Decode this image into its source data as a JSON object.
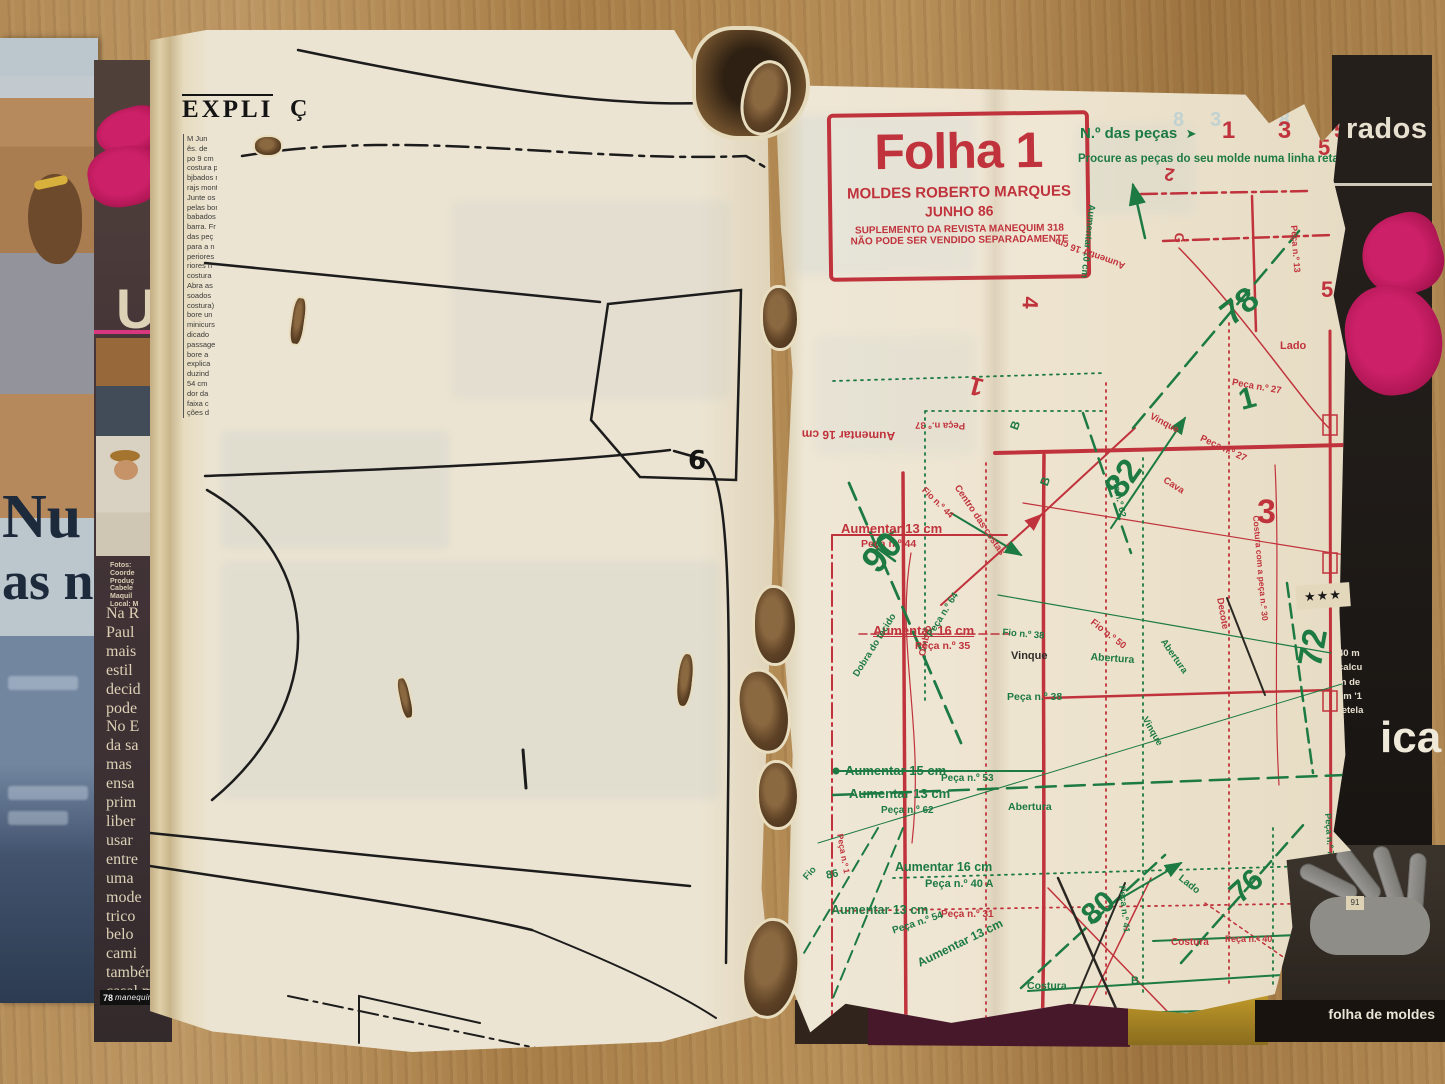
{
  "left_cover": {
    "headline_line1": "Nu",
    "headline_line2": "as n"
  },
  "middle_strip": {
    "big_letters": [
      "U",
      "d",
      "q"
    ],
    "credits": [
      "Fotos:",
      "Coorde",
      "Produç",
      "Cabele",
      "Maquil",
      "Local: M"
    ],
    "article_words": [
      "Na R",
      "Paul",
      "mais",
      "estil",
      "decid",
      "pode",
      "No E",
      "da sa",
      "mas",
      "ensa",
      "prim",
      "liber",
      "usar",
      "entre",
      "uma",
      "mode",
      "trico",
      "belo",
      "cami",
      "tambén",
      "casal m"
    ],
    "footer_number": "78",
    "footer_logo": "manequim"
  },
  "left_page": {
    "header_fragment": "EXPLI",
    "header_fragment2": "Ç",
    "column_lines": [
      "M Jun",
      "ês. de",
      "po 9 cm",
      "costura p",
      "bjbados r",
      "rajs mont",
      "Junte os",
      "pelas bor",
      "babados",
      "barra. Fr",
      "das peç",
      "para a n",
      "periores",
      "riores n",
      "costura",
      "Abra as",
      "soados",
      "costura)",
      "bore un",
      "minicurs",
      "dicado",
      "passage",
      "bore a",
      "explica",
      "duzind",
      "54 cm",
      "dor da",
      "faixa c",
      "ções d"
    ],
    "pattern_number": "6"
  },
  "right_page": {
    "info_box": {
      "title": "Folha 1",
      "publisher": "MOLDES ROBERTO MARQUES",
      "date": "JUNHO 86",
      "line3": "SUPLEMENTO DA REVISTA MANEQUIM 318",
      "line4": "NÃO PODE SER VENDIDO SEPARADAMENTE"
    },
    "pieces_header": {
      "label": "N.º das peças",
      "arrow_glyph": "➤",
      "numbers": [
        "1",
        "3",
        "5"
      ],
      "instruction": "Procure as peças do seu molde numa linha reta, v"
    },
    "ghost_numbers": "83 85",
    "labels": [
      {
        "t": "Aumentar 13  cm",
        "c": "red",
        "x": 66,
        "y": 436,
        "s": 13,
        "u": 1
      },
      {
        "t": "Peça n.º 44",
        "c": "red",
        "x": 86,
        "y": 453,
        "s": 10.5
      },
      {
        "t": "90",
        "c": "green",
        "x": 78,
        "y": 468,
        "r": -48,
        "s": 36
      },
      {
        "t": "Aumentar 16  cm",
        "c": "red",
        "x": 98,
        "y": 538,
        "s": 13,
        "u": 1
      },
      {
        "t": "Peça n.º 35",
        "c": "red",
        "x": 140,
        "y": 555,
        "s": 10.5
      },
      {
        "t": "Centro das costas",
        "c": "red",
        "x": 186,
        "y": 398,
        "r": 56,
        "s": 9.5
      },
      {
        "t": "Vinque",
        "c": "dark",
        "x": 236,
        "y": 565,
        "s": 11
      },
      {
        "t": "Fio n.º 38",
        "c": "green",
        "x": 228,
        "y": 542,
        "r": 5,
        "s": 9.5
      },
      {
        "t": "Abertura",
        "c": "green",
        "x": 316,
        "y": 566,
        "r": 4,
        "s": 10.5
      },
      {
        "t": "Fio n.º 50",
        "c": "red",
        "x": 320,
        "y": 532,
        "r": 38,
        "s": 9.5
      },
      {
        "t": "Peça n.º 38",
        "c": "green",
        "x": 232,
        "y": 606,
        "s": 10.5
      },
      {
        "t": "Ombro",
        "c": "red",
        "x": 142,
        "y": 570,
        "r": -78,
        "s": 9.5
      },
      {
        "t": "Dobra do tecido",
        "c": "green",
        "x": 76,
        "y": 588,
        "r": -58,
        "s": 9.5
      },
      {
        "t": "Peça n.º 64",
        "c": "green",
        "x": 150,
        "y": 548,
        "r": -58,
        "s": 9.5
      },
      {
        "t": "Aumentar 15  cm",
        "c": "green",
        "x": 70,
        "y": 678,
        "s": 13
      },
      {
        "t": "Peça n.º 53",
        "c": "green",
        "x": 166,
        "y": 688,
        "s": 10
      },
      {
        "t": "Aumentar 13  cm",
        "c": "green",
        "x": 74,
        "y": 701,
        "s": 13
      },
      {
        "t": "Peça n.º 62",
        "c": "green",
        "x": 106,
        "y": 720,
        "s": 10
      },
      {
        "t": "Abertura",
        "c": "green",
        "x": 233,
        "y": 716,
        "s": 10.5
      },
      {
        "t": "Aumentar 16  cm",
        "c": "green",
        "x": 120,
        "y": 775,
        "s": 12.5
      },
      {
        "t": "Peça n.º 40 A",
        "c": "green",
        "x": 150,
        "y": 793,
        "s": 11
      },
      {
        "t": "86",
        "c": "green",
        "x": 50,
        "y": 785,
        "r": -12,
        "s": 11
      },
      {
        "t": "Aumentar 13  cm",
        "c": "green",
        "x": 56,
        "y": 818,
        "s": 12.5
      },
      {
        "t": "Peça n.º 31",
        "c": "red",
        "x": 166,
        "y": 824,
        "s": 10
      },
      {
        "t": "Peça n.º 54",
        "c": "green",
        "x": 116,
        "y": 841,
        "r": -18,
        "s": 10
      },
      {
        "t": "Aumentar 13  cm",
        "c": "green",
        "x": 140,
        "y": 872,
        "r": -26,
        "s": 12
      },
      {
        "t": "Fio",
        "c": "green",
        "x": 26,
        "y": 790,
        "r": -48,
        "s": 9.5
      },
      {
        "t": "Peça n.º 1",
        "c": "red",
        "x": 70,
        "y": 748,
        "r": 80,
        "s": 8.5
      },
      {
        "t": "80",
        "c": "green",
        "x": 300,
        "y": 822,
        "r": -42,
        "s": 30
      },
      {
        "t": "76",
        "c": "green",
        "x": 448,
        "y": 800,
        "r": -42,
        "s": 30
      },
      {
        "t": "Peça n.º 41",
        "c": "green",
        "x": 352,
        "y": 800,
        "r": 84,
        "s": 9
      },
      {
        "t": "Costura",
        "c": "red",
        "x": 396,
        "y": 852,
        "s": 10
      },
      {
        "t": "Peça n.º 40",
        "c": "red",
        "x": 450,
        "y": 849,
        "s": 9
      },
      {
        "t": "Costura",
        "c": "green",
        "x": 252,
        "y": 895,
        "s": 10.5
      },
      {
        "t": "Fio n.º 54",
        "c": "green",
        "x": 260,
        "y": 925,
        "s": 10
      },
      {
        "t": "Lado",
        "c": "green",
        "x": 408,
        "y": 788,
        "r": 38,
        "s": 10
      },
      {
        "t": "B",
        "c": "green",
        "x": 356,
        "y": 890,
        "s": 11
      },
      {
        "t": "82",
        "c": "green",
        "x": 322,
        "y": 398,
        "r": -55,
        "s": 34
      },
      {
        "t": "78",
        "c": "green",
        "x": 438,
        "y": 218,
        "r": -38,
        "s": 34
      },
      {
        "t": "Lado",
        "c": "red",
        "x": 505,
        "y": 255,
        "s": 11
      },
      {
        "t": "Peça n.º 27",
        "c": "red",
        "x": 458,
        "y": 292,
        "r": 10,
        "s": 9.5
      },
      {
        "t": "1",
        "c": "green",
        "x": 460,
        "y": 300,
        "r": -15,
        "s": 30
      },
      {
        "t": "Vinque",
        "c": "red",
        "x": 378,
        "y": 326,
        "r": 28,
        "s": 9.5
      },
      {
        "t": "Peça n.º 27",
        "c": "red",
        "x": 428,
        "y": 348,
        "r": 25,
        "s": 9.5
      },
      {
        "t": "Cava",
        "c": "red",
        "x": 392,
        "y": 390,
        "r": 32,
        "s": 9.5
      },
      {
        "t": "Fio n.º 62",
        "c": "green",
        "x": 345,
        "y": 392,
        "r": 78,
        "s": 9
      },
      {
        "t": "3",
        "c": "red",
        "x": 482,
        "y": 408,
        "s": 34
      },
      {
        "t": "2",
        "c": "red",
        "x": 398,
        "y": 100,
        "r": 188,
        "s": 18
      },
      {
        "t": "G",
        "c": "red",
        "x": 412,
        "y": 148,
        "r": 92,
        "s": 13
      },
      {
        "t": "Peça n.º 13",
        "c": "red",
        "x": 524,
        "y": 140,
        "r": 86,
        "s": 9
      },
      {
        "t": "5",
        "c": "red",
        "x": 543,
        "y": 50,
        "s": 22
      },
      {
        "t": "5",
        "c": "red",
        "x": 546,
        "y": 192,
        "s": 22
      },
      {
        "t": "Aumentar 16  cm",
        "c": "red",
        "x": 120,
        "y": 358,
        "r": 181,
        "s": 12
      },
      {
        "t": "Peça n.º 37",
        "c": "red",
        "x": 190,
        "y": 346,
        "r": 181,
        "s": 9.5
      },
      {
        "t": "1",
        "c": "red",
        "x": 204,
        "y": 318,
        "r": 195,
        "s": 26
      },
      {
        "t": "B",
        "c": "green",
        "x": 232,
        "y": 342,
        "r": -70,
        "s": 12
      },
      {
        "t": "B",
        "c": "green",
        "x": 262,
        "y": 398,
        "r": -70,
        "s": 12
      },
      {
        "t": "Fio n.º 44",
        "c": "red",
        "x": 152,
        "y": 400,
        "r": 44,
        "s": 9
      },
      {
        "t": "Aumentar 10 cm",
        "c": "green",
        "x": 322,
        "y": 120,
        "r": 96,
        "s": 9.5
      },
      {
        "t": "Aumentar 16 cm",
        "c": "red",
        "x": 348,
        "y": 186,
        "r": 200,
        "s": 9.5
      },
      {
        "t": "Decote",
        "c": "red",
        "x": 450,
        "y": 512,
        "r": 80,
        "s": 9.5
      },
      {
        "t": "Costura com a peça n.º 30",
        "c": "red",
        "x": 486,
        "y": 430,
        "r": 85,
        "s": 8.5
      },
      {
        "t": "Abertura",
        "c": "green",
        "x": 392,
        "y": 552,
        "r": 55,
        "s": 9.5
      },
      {
        "t": "Vinque",
        "c": "green",
        "x": 374,
        "y": 630,
        "r": 60,
        "s": 9.5
      },
      {
        "t": "72",
        "c": "green",
        "x": 516,
        "y": 578,
        "r": -80,
        "s": 34
      },
      {
        "t": "Peça n.º 77",
        "c": "green",
        "x": 558,
        "y": 728,
        "r": 86,
        "s": 9
      },
      {
        "t": "Peça n.º 54",
        "c": "dark",
        "x": 340,
        "y": 926,
        "s": 9.5
      },
      {
        "t": "4",
        "c": "red",
        "x": 268,
        "y": 212,
        "r": 92,
        "s": 22
      }
    ]
  },
  "right_cover": {
    "masthead_fragment": "rados",
    "snippet_lines": [
      "40 m",
      "calcu",
      "m de",
      "cm '1",
      "retela"
    ],
    "big_word_fragment": "ica",
    "stars": "★★★",
    "corner_number": "91",
    "footer_band": "folha de moldes"
  },
  "colors": {
    "pattern_red": "#c0333c",
    "pattern_green": "#1d7a42",
    "accent_magenta": "#c2185b"
  }
}
